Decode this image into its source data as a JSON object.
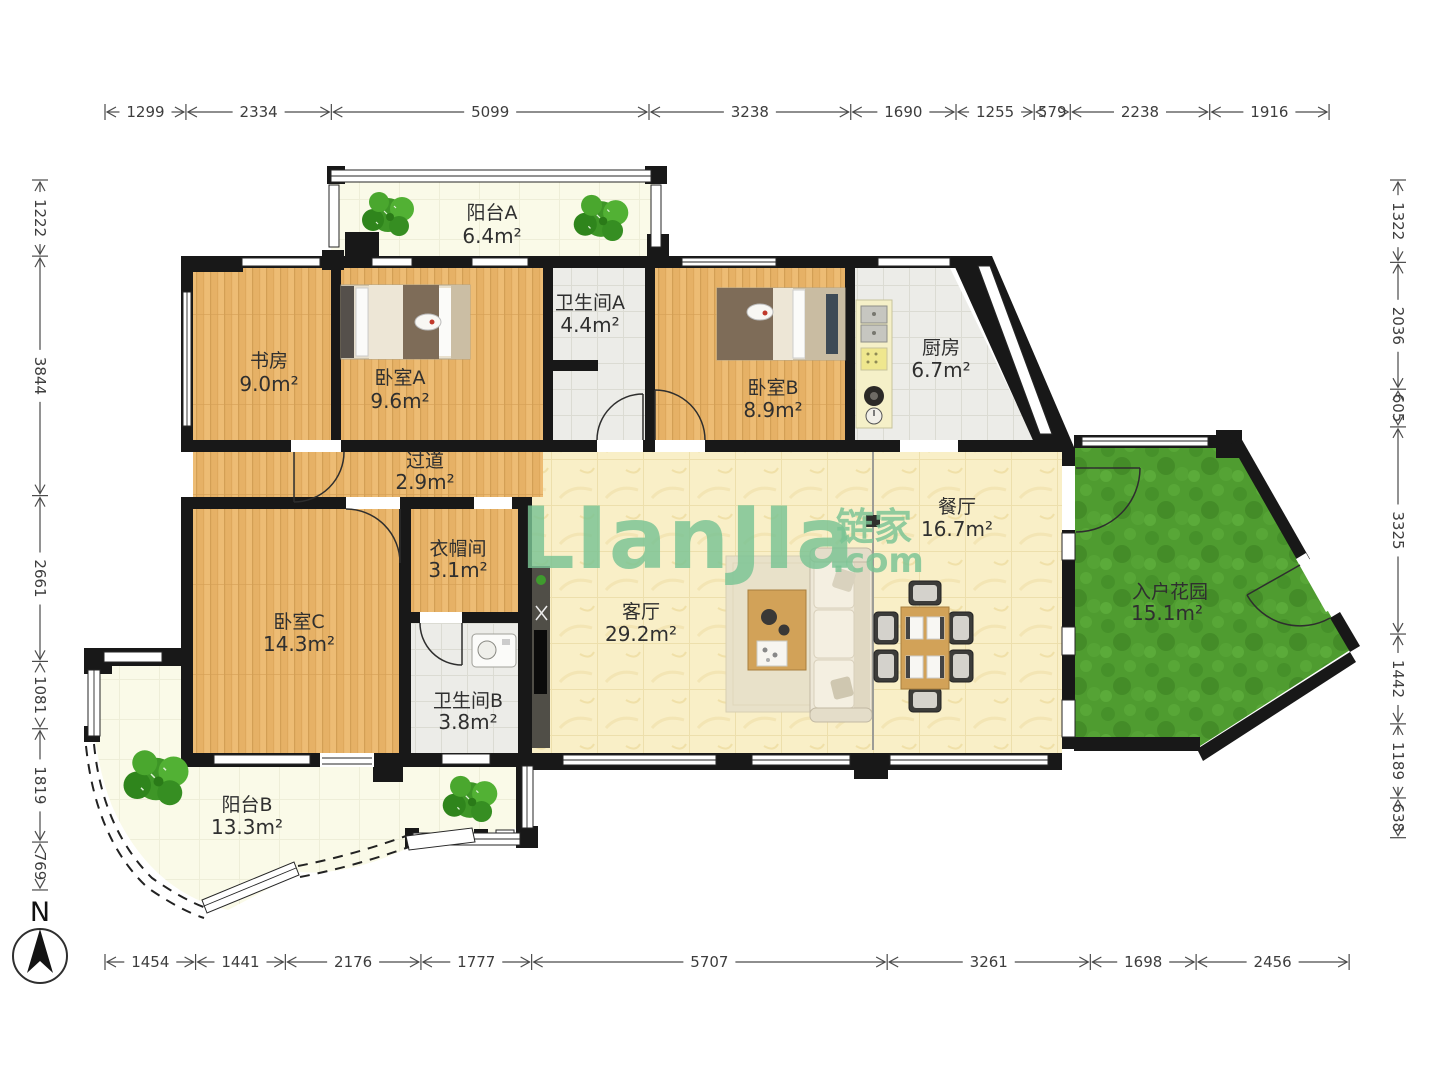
{
  "watermark": {
    "main": "LIanJIa",
    "cn": "链家",
    "com": ".com",
    "color": "#7AC494"
  },
  "compass": {
    "label": "N"
  },
  "rulers": {
    "unit_scale_note": "",
    "top": [
      1299,
      2334,
      5099,
      3238,
      1690,
      1255,
      579,
      2238,
      1916
    ],
    "bottom": [
      1454,
      1441,
      2176,
      1777,
      5707,
      3261,
      1698,
      2456
    ],
    "left": [
      1222,
      3844,
      2661,
      1081,
      1819,
      769
    ],
    "right": [
      1322,
      2036,
      605,
      3325,
      1442,
      1189,
      638
    ]
  },
  "rooms": [
    {
      "id": "balcony-a",
      "name": "阳台A",
      "area": "6.4m²"
    },
    {
      "id": "study",
      "name": "书房",
      "area": "9.0m²"
    },
    {
      "id": "bedroom-a",
      "name": "卧室A",
      "area": "9.6m²"
    },
    {
      "id": "bath-a",
      "name": "卫生间A",
      "area": "4.4m²"
    },
    {
      "id": "bedroom-b",
      "name": "卧室B",
      "area": "8.9m²"
    },
    {
      "id": "kitchen",
      "name": "厨房",
      "area": "6.7m²"
    },
    {
      "id": "hallway",
      "name": "过道",
      "area": "2.9m²"
    },
    {
      "id": "dining",
      "name": "餐厅",
      "area": "16.7m²"
    },
    {
      "id": "cloakroom",
      "name": "衣帽间",
      "area": "3.1m²"
    },
    {
      "id": "living",
      "name": "客厅",
      "area": "29.2m²"
    },
    {
      "id": "bedroom-c",
      "name": "卧室C",
      "area": "14.3m²"
    },
    {
      "id": "bath-b",
      "name": "卫生间B",
      "area": "3.8m²"
    },
    {
      "id": "garden",
      "name": "入户花园",
      "area": "15.1m²"
    },
    {
      "id": "balcony-b",
      "name": "阳台B",
      "area": "13.3m²"
    }
  ]
}
